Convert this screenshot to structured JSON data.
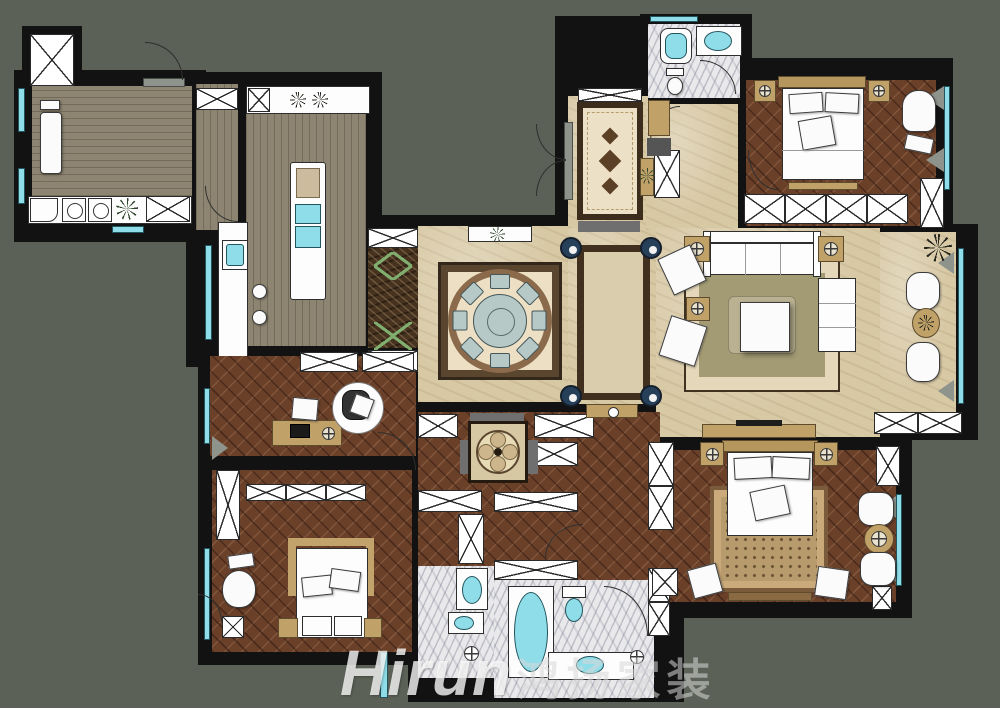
{
  "watermark": {
    "brand": "Hirun",
    "suffix": "鸿扬家装"
  },
  "palette": {
    "background": "#5b6156",
    "wall": "#121212",
    "beige_marble": "#d8c9a5",
    "white_marble": "#e9e9ec",
    "emperador": "#46321e",
    "herringbone_wood": "#6b4029",
    "gray_wood": "#8d8571",
    "fixture_cyan": "#8fdde8",
    "furniture_tan": "#c0a269",
    "navy_marker": "#27405a",
    "rug_green": "#a29b74",
    "rug_cream": "#e5d8ba",
    "zigzag_green": "#7fae6f",
    "plant_green": "#2d452b"
  },
  "icons": {
    "plant": "starburst",
    "stove-burner": "starburst",
    "compass-marker": "crosshair-circle",
    "closet": "x-box",
    "column-marker": "navy-circle"
  }
}
